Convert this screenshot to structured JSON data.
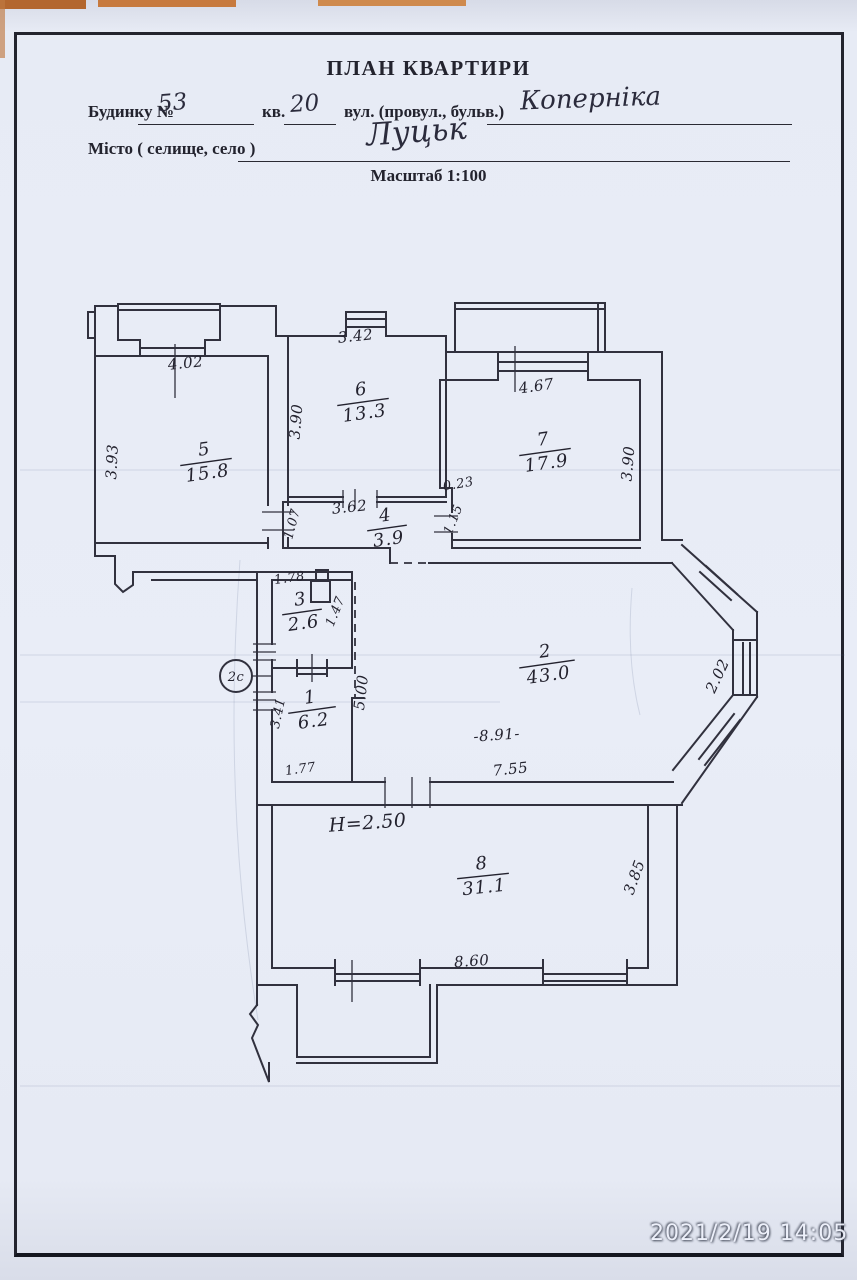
{
  "header": {
    "title": "ПЛАН КВАРТИРИ",
    "building_label": "Будинку №",
    "building_value": "53",
    "apartment_label": "кв.",
    "apartment_value": "20",
    "street_label": "вул. (провул., бульв.)",
    "street_value": "Коперніка",
    "city_label": "Місто ( селище, село )",
    "city_value": "Луцьк",
    "scale_label": "Масштаб 1:100"
  },
  "plan": {
    "rooms": [
      {
        "number": "1",
        "area": "6.2"
      },
      {
        "number": "2",
        "area": "43.0"
      },
      {
        "number": "3",
        "area": "2.6"
      },
      {
        "number": "4",
        "area": "3.9"
      },
      {
        "number": "5",
        "area": "15.8"
      },
      {
        "number": "6",
        "area": "13.3"
      },
      {
        "number": "7",
        "area": "17.9"
      },
      {
        "number": "8",
        "area": "31.1"
      }
    ],
    "dims": {
      "top_room5": "4.02",
      "left_room5": "3.93",
      "top_room6": "3.42",
      "left_room6": "3.90",
      "top_room7": "4.67",
      "right_room7": "3.90",
      "jog_width": "0.23",
      "jog_height": "1.15",
      "top_room4": "3.62",
      "left_room4": "1.07",
      "top_room3": "1.78",
      "right_room3": "1.47",
      "corridor_length": "5.00",
      "left_room1": "3.41",
      "bottom_room1": "1.77",
      "room2_width": "-8.91-",
      "bottom_room2": "7.55",
      "bay_window": "2.02",
      "height_note": "H=2.50",
      "bottom_room8": "8.60",
      "right_room8": "3.85",
      "circle_mark": "2с"
    }
  },
  "photo": {
    "timestamp": "2021/2/19 14:05"
  }
}
